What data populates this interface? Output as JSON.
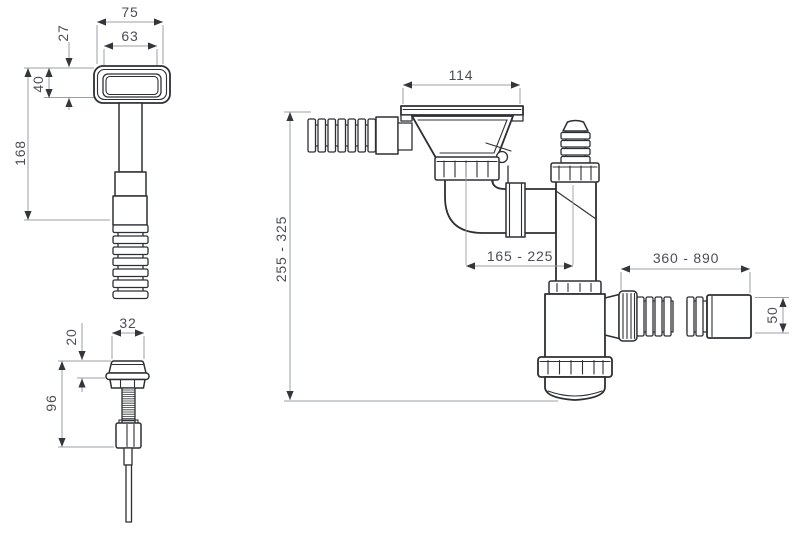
{
  "diagram": {
    "type": "technical-drawing",
    "colors": {
      "outline": "#2c3034",
      "dimension_line": "#9aa0a6",
      "arrow": "#33373c",
      "text": "#4a4f55",
      "background": "#ffffff"
    },
    "parts": {
      "overflow": {
        "label": "overflow-assembly",
        "dims": {
          "outer_width": "75",
          "inner_width": "63",
          "depth": "27",
          "head_height": "40",
          "length": "168"
        }
      },
      "pin": {
        "label": "drain-pin",
        "dims": {
          "cap_width": "32",
          "cap_height": "20",
          "length": "96"
        }
      },
      "siphon": {
        "label": "siphon-assembly",
        "dims": {
          "strainer_width": "114",
          "height_range": "255 - 325",
          "horizontal_range": "165 - 225",
          "outlet_hose_range": "360 - 890",
          "outlet_diameter": "50"
        }
      }
    }
  }
}
